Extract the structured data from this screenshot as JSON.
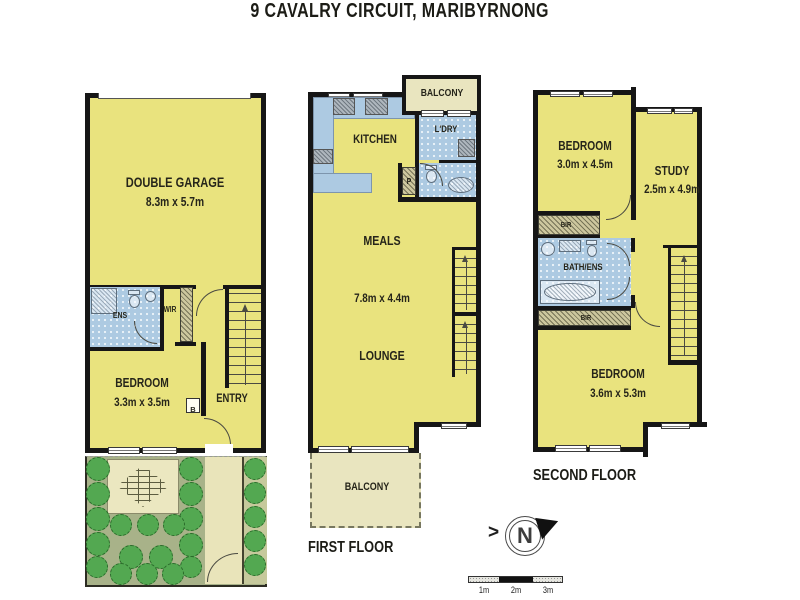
{
  "title": "9 CAVALRY CIRCUIT, MARIBYRNONG",
  "ground_floor": {
    "garage": {
      "name": "DOUBLE GARAGE",
      "dims": "8.3m x 5.7m"
    },
    "ens": "ENS",
    "wir": "WIR",
    "bedroom": {
      "name": "BEDROOM",
      "dims": "3.3m x 3.5m"
    },
    "entry": "ENTRY",
    "cupboard": "B"
  },
  "first_floor": {
    "caption": "FIRST FLOOR",
    "balcony_top": "BALCONY",
    "kitchen": "KITCHEN",
    "laundry": "L'DRY",
    "pantry": "P",
    "meals": "MEALS",
    "dims": "7.8m x 4.4m",
    "lounge": "LOUNGE",
    "balcony_bottom": "BALCONY"
  },
  "second_floor": {
    "caption": "SECOND FLOOR",
    "bedroom1": {
      "name": "BEDROOM",
      "dims": "3.0m x 4.5m"
    },
    "study": {
      "name": "STUDY",
      "dims": "2.5m x 4.9m"
    },
    "bir_top": "BIR",
    "bath": "BATH/ENS",
    "bir_bottom": "BIR",
    "bedroom2": {
      "name": "BEDROOM",
      "dims": "3.6m x 5.3m"
    }
  },
  "compass": {
    "north": "N"
  },
  "scale_bar": {
    "labels": [
      "1m",
      "2m",
      "3m"
    ]
  },
  "colors": {
    "room_fill": "#e9e37e",
    "wet_area_fill": "#adcae2",
    "balcony_fill": "#e9e5bf",
    "wall": "#161616",
    "garden_bed": "#a8b289",
    "bush_green": "#53a851",
    "paving": "#e9e4ba",
    "robe_hatch": "#cdc79e"
  }
}
